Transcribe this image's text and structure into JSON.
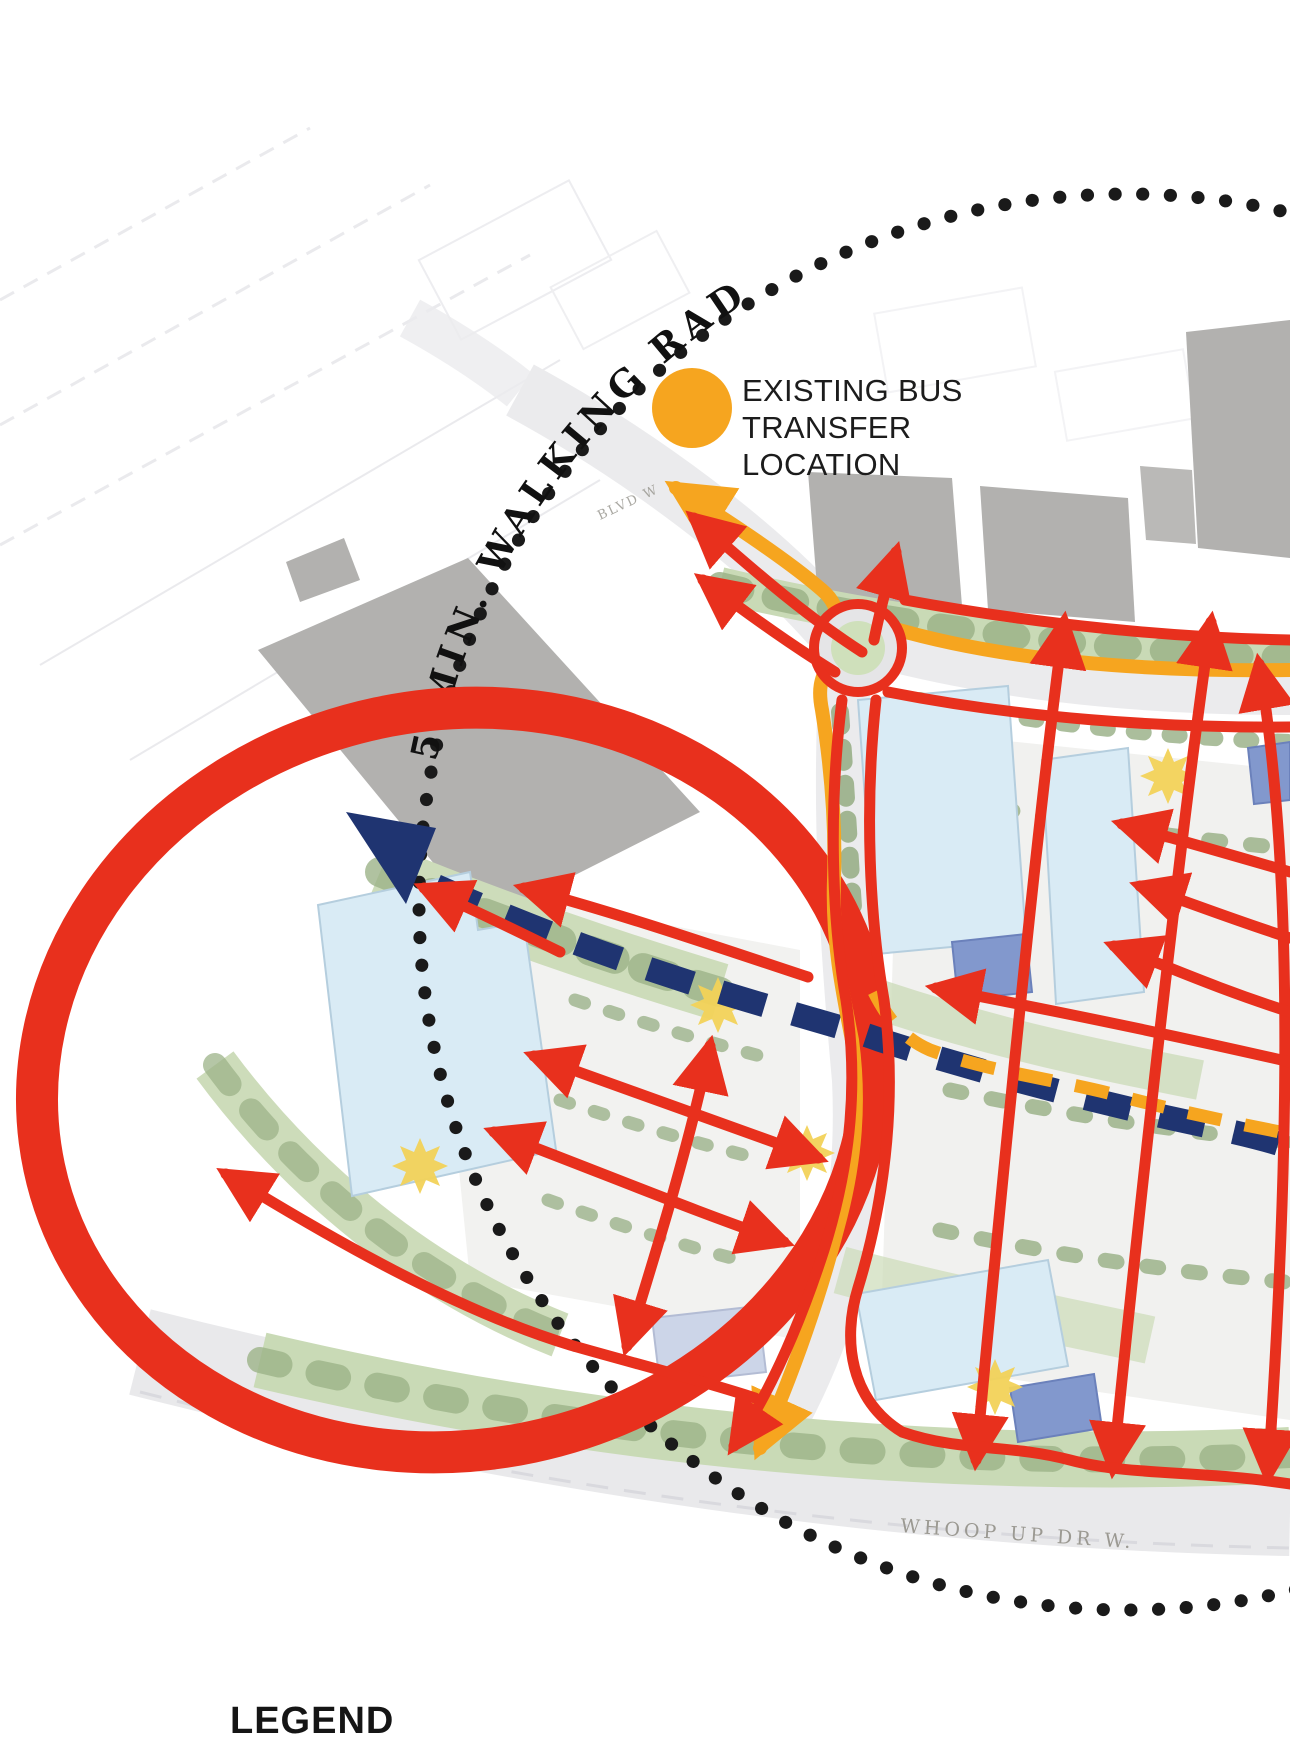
{
  "map": {
    "bus_transfer": {
      "line1": "EXISTING BUS",
      "line2": "TRANSFER",
      "line3": "LOCATION"
    },
    "walking_radius_label": "5 MIN. WALKING RADIUS",
    "street_label_south": "WHOOP UP DR W.",
    "street_label_north": "BLVD W",
    "legend_title": "LEGEND"
  },
  "colors": {
    "red": "#E8301D",
    "orange": "#F6A51F",
    "navy": "#1F3471",
    "black": "#1A1A1A",
    "building_light_blue": "#D9EBF5",
    "building_medium_blue": "#8298CD",
    "building_lavender": "#CCD5E8",
    "building_grey": "#B2B1AF",
    "green": "#C9DAB6",
    "tree_green": "#96AF82",
    "road_grey": "#EBEBED",
    "street_text_grey": "#9B9992"
  }
}
